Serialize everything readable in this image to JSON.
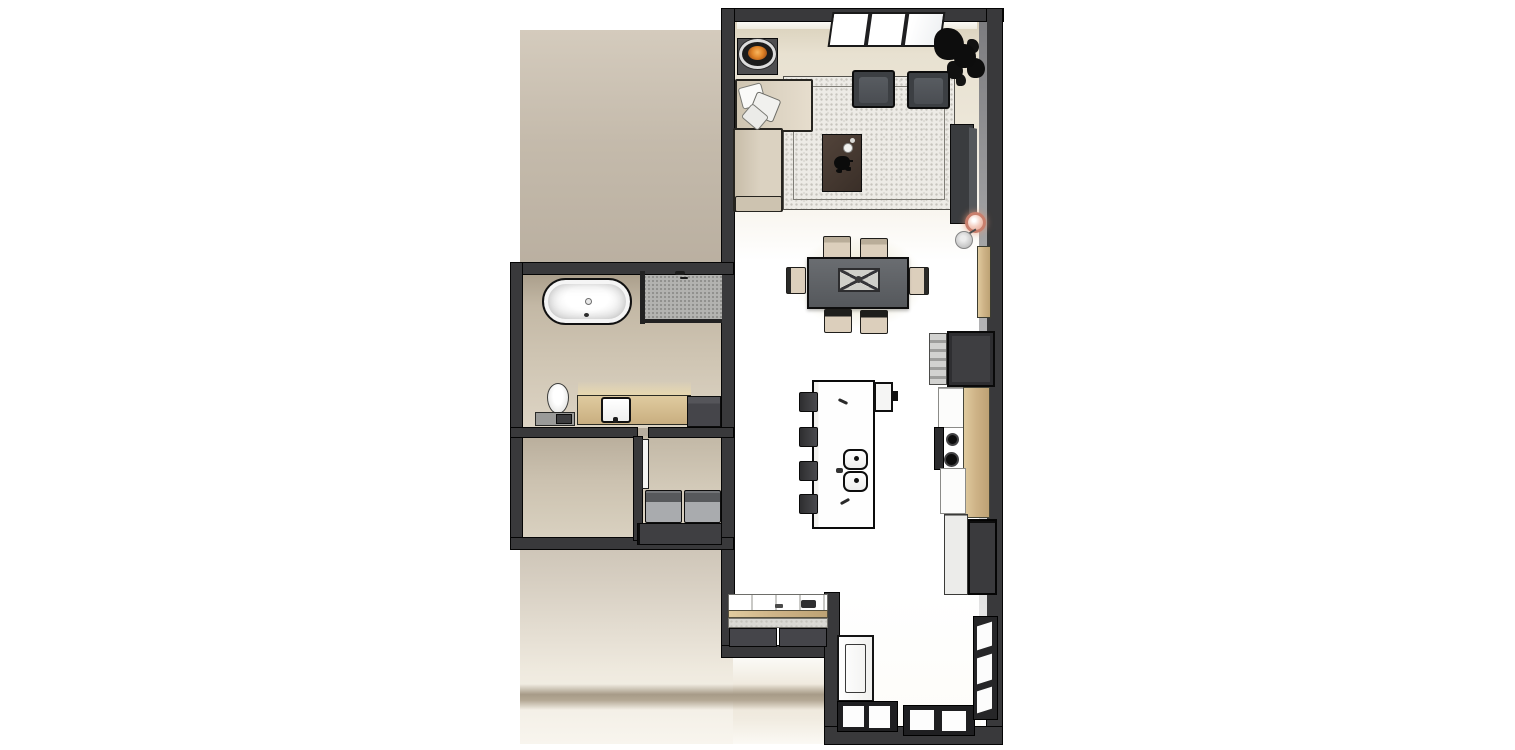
{
  "meta": {
    "title": "3D apartment floor plan render, top-down view",
    "view": "top-down perspective",
    "style": "architectural 3D render"
  },
  "colors": {
    "wall": "#39393b",
    "floor": "#ffffff",
    "floorwarm": "#e7dfcf",
    "sidefloor": "#b4aa9b",
    "bathfloor": "#cfc5b3",
    "wood": "#cdb488",
    "rug": "#edebe6",
    "sofa": "#d7cebd",
    "chair": "#d9cfbe",
    "table": "#606468",
    "island": "#fdfdfd",
    "cabinet": "#3f3f42",
    "appliance": "#a9abae",
    "fire": "#d97c26",
    "pendant": "#cf8270",
    "tub": "#fbfbfb",
    "glow": "#e2dcba"
  },
  "rooms": [
    {
      "name": "Living Room",
      "items": [
        "fireplace bowl on plinth",
        "corner sofa with scatter cushions",
        "two lounge armchairs",
        "speckled area rug",
        "dark timber coffee table with vase and plant",
        "wall-mounted media console",
        "indoor plant",
        "full-height window"
      ]
    },
    {
      "name": "Dining Area",
      "items": [
        "rectangular dining table",
        "six upholstered chairs",
        "centerpiece tray",
        "pendant lamp",
        "floor lamp",
        "timber wall panel"
      ]
    },
    {
      "name": "Kitchen",
      "items": [
        "island with double sink",
        "four bar stools",
        "island cooktop appliance",
        "tall fridge cabinet",
        "countertop appliance stack",
        "range with two burners",
        "timber worktop",
        "light drawer stack",
        "dark drawer stack"
      ]
    },
    {
      "name": "Bathroom",
      "items": [
        "freestanding oval bathtub",
        "walk-in shower with glass screen",
        "timber vanity with basin and mirror",
        "toilet",
        "low cabinet",
        "dark storage cabinet"
      ]
    },
    {
      "name": "Laundry",
      "items": [
        "washing machine",
        "dryer",
        "base cabinet",
        "internal door"
      ]
    },
    {
      "name": "Entry",
      "items": [
        "entry door leaf",
        "built-in sideboard with counter",
        "two base cabinets",
        "bottom window pair",
        "glazed corner windows"
      ]
    },
    {
      "name": "Adjacent Zone",
      "items": [
        "timber floor area"
      ]
    }
  ]
}
